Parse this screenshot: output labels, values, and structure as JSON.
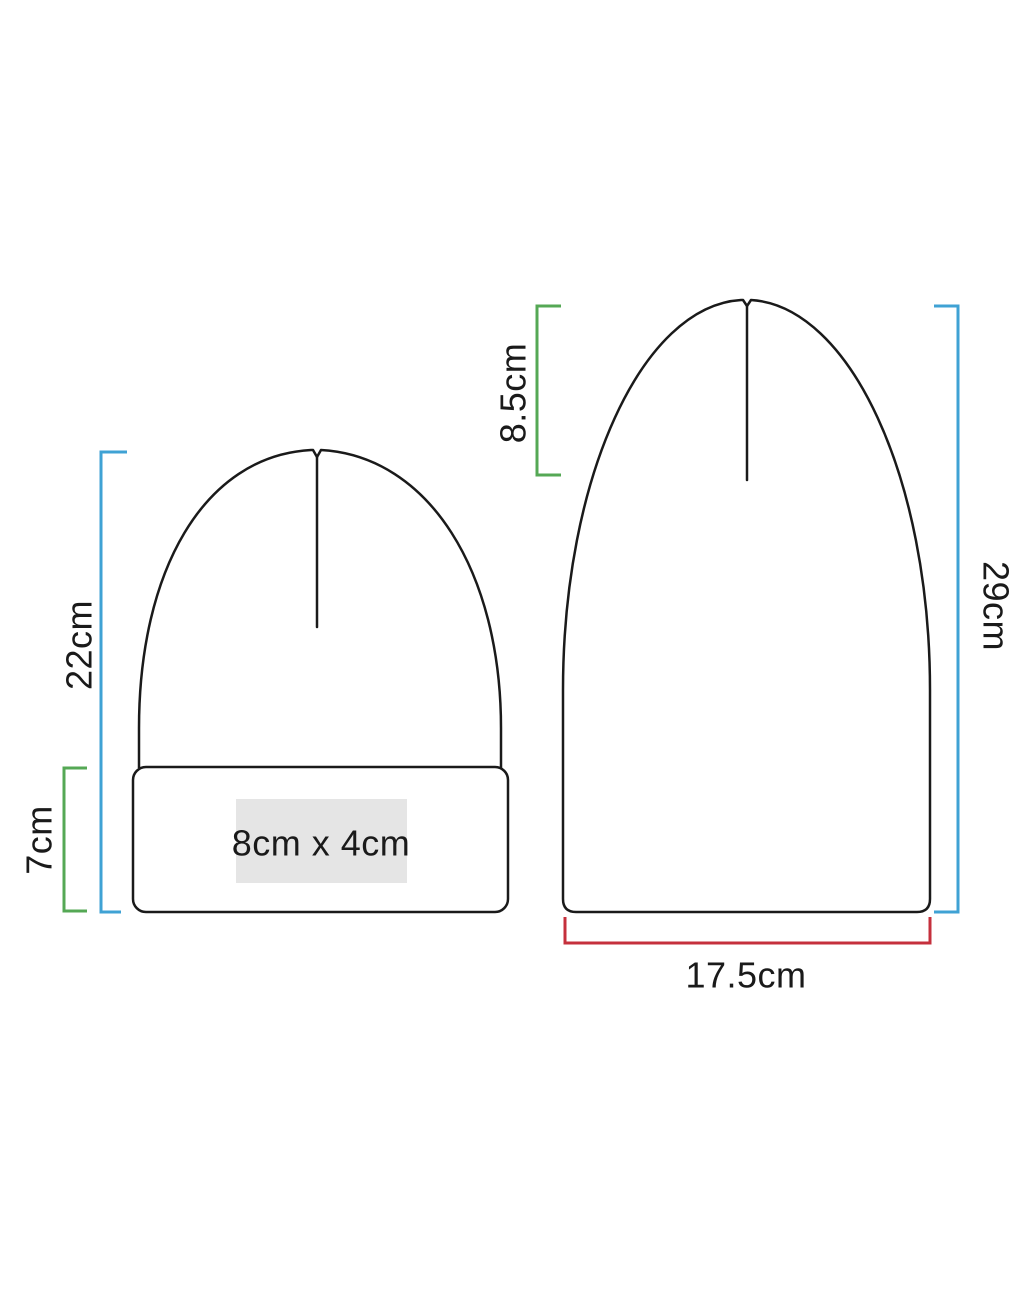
{
  "diagram": {
    "type": "product-dimensions",
    "subject": "beanie-hat-size-chart",
    "colors": {
      "outline": "#1a1a1a",
      "text": "#1a1a1a",
      "blue_bracket": "#3fa2d4",
      "green_bracket": "#55a855",
      "red_bracket": "#c5303c",
      "print_area_fill": "#e5e5e5"
    },
    "cuffed_beanie": {
      "height_label": "22cm",
      "cuff_height_label": "7cm",
      "print_area_label": "8cm x 4cm"
    },
    "uncuffed_beanie": {
      "height_label": "29cm",
      "crown_height_label": "8.5cm",
      "width_label": "17.5cm"
    }
  }
}
